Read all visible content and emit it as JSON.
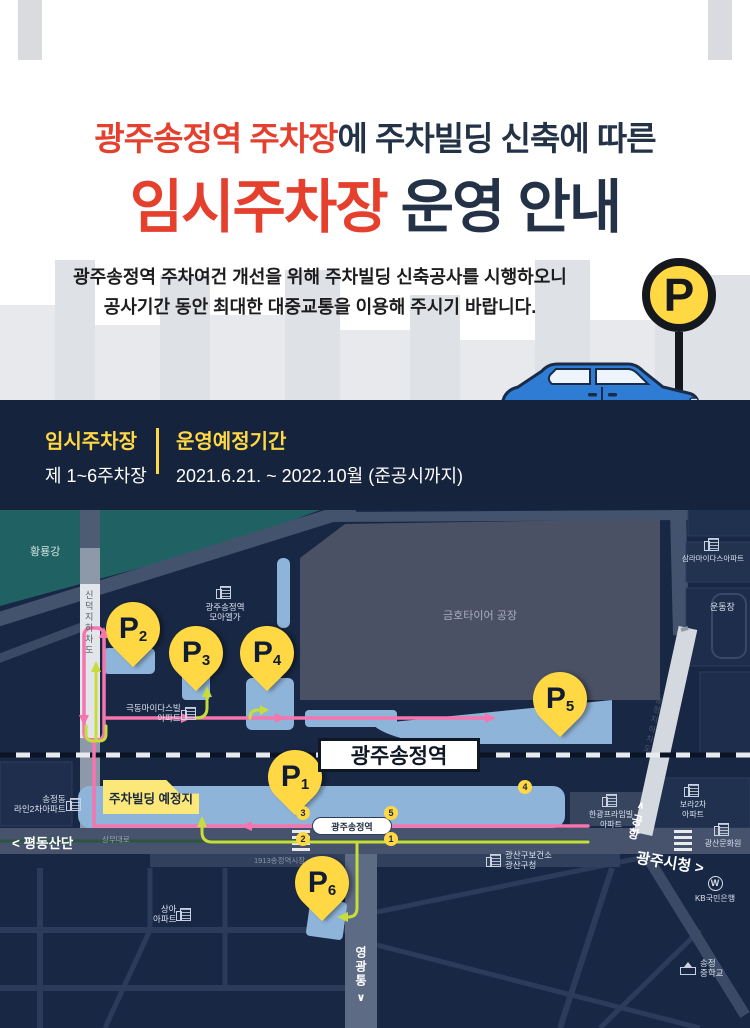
{
  "poster": {
    "headline_highlight": "광주송정역 주차장",
    "headline_rest": "에 주차빌딩 신축에 따른",
    "title_highlight": "임시주차장",
    "title_rest": " 운영 안내",
    "desc_line1": "광주송정역 주차여건 개선을 위해 주차빌딩 신축공사를 시행하오니",
    "desc_line2": "공사기간 동안 최대한 대중교통을 이용해 주시기 바랍니다.",
    "p_sign": "P"
  },
  "band": {
    "lot_label": "임시주차장",
    "lot_value": "제 1~6주차장",
    "period_label": "운영예정기간",
    "period_value": "2021.6.21. ~ 2022.10월 (준공시까지)"
  },
  "colors": {
    "accent_red": "#e5402e",
    "navy": "#16233c",
    "yellow": "#ffd843",
    "map_bg": "#182743",
    "parking_blue": "#8fb4d9",
    "route_pink": "#f575ae",
    "route_green": "#c8dc3c",
    "river_teal": "#206263"
  },
  "map": {
    "station_box": "광주송정역",
    "subway_pill": "광주송정역",
    "exit_3": "3",
    "exit_5": "5",
    "exit_2": "2",
    "exit_1": "1",
    "exit_4": "4",
    "callout": "주차빌딩 예정지",
    "river": "황룡강",
    "factory": "금호타이어 공장",
    "road_sinduk": "신덕지하차도",
    "road_songjeong_underpass": "송정지하차도",
    "road_sangmu": "상무대로",
    "market": "1913송정역시장",
    "dir_west": "< 평동산단",
    "dir_east": "광주시청 >",
    "dir_airport": "공항",
    "dir_airport_chevron": "∧",
    "dir_south": "영광통",
    "dir_south_chevron": "∨",
    "pins": {
      "p1": {
        "letter": "P",
        "num": "1"
      },
      "p2": {
        "letter": "P",
        "num": "2"
      },
      "p3": {
        "letter": "P",
        "num": "3"
      },
      "p4": {
        "letter": "P",
        "num": "4"
      },
      "p5": {
        "letter": "P",
        "num": "5"
      },
      "p6": {
        "letter": "P",
        "num": "6"
      }
    },
    "labels": {
      "moaelga": "광주송정역\n모아엘가",
      "samra": "삼라마이다스아파트",
      "undongjang": "운동장",
      "kukdong": "극동마이다스빌\n아파트",
      "line2": "송정동\n라인2차아파트",
      "hangwang": "한광프라임빌\n아파트",
      "bora": "보라2차\n아파트",
      "munhwa": "광산문화원",
      "boksa": "광산구보건소\n광산구청",
      "kb_mark": "W",
      "kb": "KB국민은행",
      "school": "송정\n중학교",
      "sanga": "상아\n아파트"
    }
  }
}
